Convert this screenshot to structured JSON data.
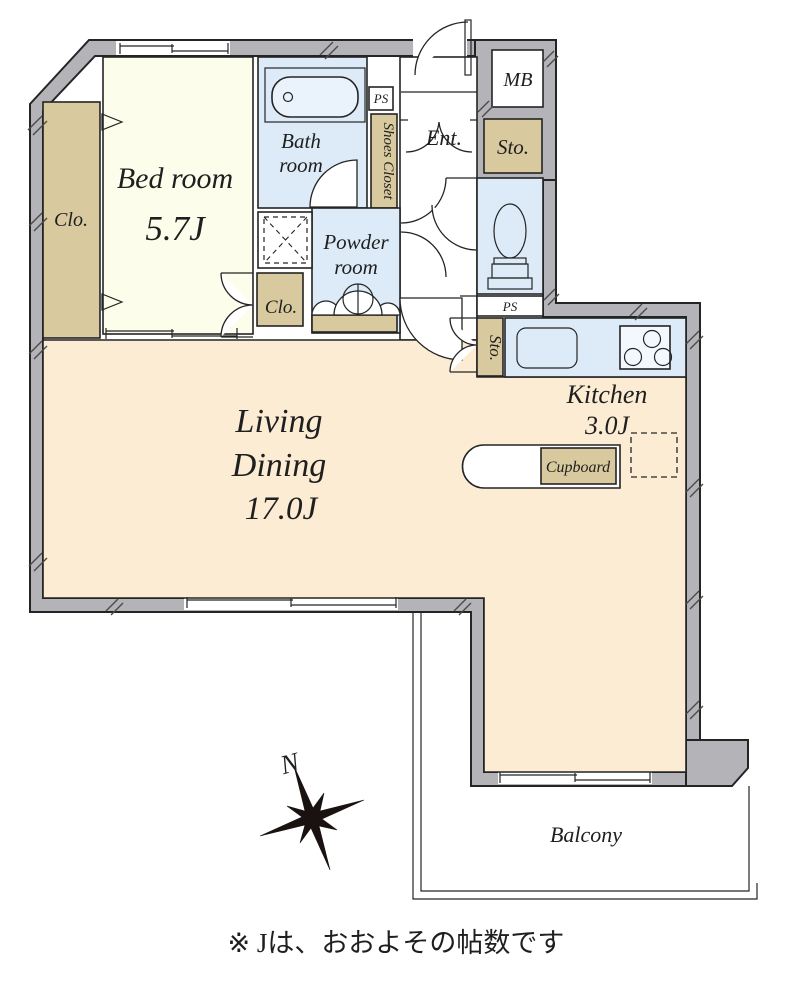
{
  "rooms": {
    "bedroom": {
      "name": "Bed room",
      "area": "5.7J"
    },
    "living_dining": {
      "line1": "Living",
      "line2": "Dining",
      "area": "17.0J"
    },
    "kitchen": {
      "name": "Kitchen",
      "area": "3.0J"
    },
    "bathroom": {
      "line1": "Bath",
      "line2": "room"
    },
    "powder_room": {
      "line1": "Powder",
      "line2": "room"
    },
    "entrance": {
      "name": "Ent."
    },
    "balcony": {
      "name": "Balcony"
    }
  },
  "storage": {
    "bedroom_closet": "Clo.",
    "hall_closet": "Clo.",
    "shoes_closet": "Shoes Closet",
    "entrance_storage": "Sto.",
    "kitchen_storage": "Sto.",
    "cupboard": "Cupboard"
  },
  "utility": {
    "meter_box": "MB",
    "pipe_space_top": "PS",
    "pipe_space_mid": "PS"
  },
  "compass": {
    "north_label": "N"
  },
  "footnote": "※ Jは、おおよその帖数です",
  "colors": {
    "wall_gray": "#b4b3b8",
    "room_cream": "#fdfdeb",
    "room_peach": "#fcecd3",
    "room_blue": "#dcebf7",
    "closet_tan": "#d9c99e",
    "line_dark": "#242424"
  }
}
